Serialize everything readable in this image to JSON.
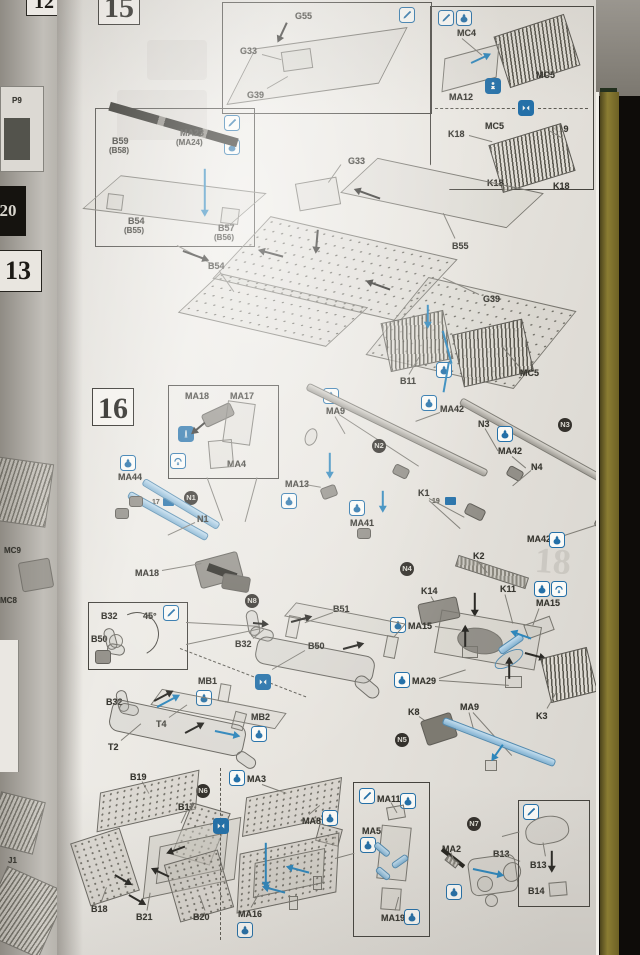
{
  "meta": {
    "description": "Photographed plastic scale-model assembly instruction sheet showing exploded-view steps 15 and 16 with part codes, cement/paint icons and subassembly badges",
    "steps_visible": [
      "15",
      "16"
    ]
  },
  "palette": {
    "page": "#e7e4df",
    "icon_blue": "#2470a8",
    "arrow_blue": "#2e86bb",
    "part_blue": "#9cc4e0",
    "badge_dark": "#34312c",
    "stripe_olive": "#8b7d33",
    "background": "#0d0b09"
  },
  "adjacent_pages": {
    "num_top": "12",
    "p9": "P9",
    "num_20": "20",
    "num_13": "13",
    "mc9": "MC9",
    "mc8": "MC8",
    "j1": "J1"
  },
  "step15": {
    "number": "15",
    "inset_top": {
      "g55": "G55",
      "g33": "G33",
      "g39": "G39"
    },
    "inset_right": {
      "mc4": "MC4",
      "mc5_top": "MC5",
      "ma12": "MA12",
      "mc5_bottom": "MC5",
      "k19": "K19",
      "k18_left": "K18",
      "k18_bl": "K18",
      "k18_br": "K18"
    },
    "inset_left": {
      "b59": "B59",
      "b59_alt": "(B58)",
      "ma23": "MA23",
      "ma23_alt": "(MA24)",
      "b54": "B54",
      "b54_alt": "(B55)",
      "b57": "B57",
      "b57_alt": "(B56)"
    },
    "main": {
      "g33": "G33",
      "b55": "B55",
      "b54": "B54",
      "g39": "G39",
      "b11": "B11",
      "mc5": "MC5"
    }
  },
  "step16": {
    "number": "16",
    "inset_tool": {
      "ma18": "MA18",
      "ma17": "MA17",
      "ma4": "MA4"
    },
    "cable": {
      "ma44": "MA44",
      "badge": "N1",
      "n1": "N1",
      "ma18": "MA18",
      "tag": "17"
    },
    "rod_k1": {
      "ma9": "MA9",
      "badge": "N2",
      "ma13": "MA13",
      "ma41": "MA41",
      "k1": "K1",
      "tag": "19"
    },
    "rods": {
      "ma42_a": "MA42",
      "n3": "N3",
      "badge": "N3",
      "ma42_b": "MA42",
      "n4": "N4",
      "ma42_c": "MA42"
    },
    "mount": {
      "badge": "N4",
      "k2": "K2",
      "k14": "K14",
      "k11": "K11",
      "ma15_r": "MA15",
      "ma15_l": "MA15",
      "ma29": "MA29",
      "k3": "K3"
    },
    "muffler": {
      "badge": "N8",
      "b51": "B51",
      "b32_top": "B32",
      "b50": "B50",
      "b32_low": "B32",
      "mb1": "MB1",
      "t4": "T4",
      "mb2": "MB2",
      "t2": "T2"
    },
    "inset_angle": {
      "b32": "B32",
      "angle": "45°",
      "b50": "B50"
    },
    "rod_k8": {
      "k8": "K8",
      "ma9": "MA9",
      "badge": "N5"
    },
    "bin_b": {
      "b19": "B19",
      "badge": "N6",
      "b17": "B17",
      "b18": "B18",
      "b21": "B21",
      "b20": "B20"
    },
    "bin_ma": {
      "ma3": "MA3",
      "ma8": "MA8",
      "ma16": "MA16"
    },
    "inset_jack": {
      "ma11": "MA11",
      "ma5": "MA5",
      "ma19": "MA19"
    },
    "light": {
      "badge": "N7",
      "ma2": "MA2",
      "b13": "B13"
    },
    "inset_lamp": {
      "b13": "B13",
      "b14": "B14"
    }
  },
  "ghost": {
    "next_step": "18"
  }
}
